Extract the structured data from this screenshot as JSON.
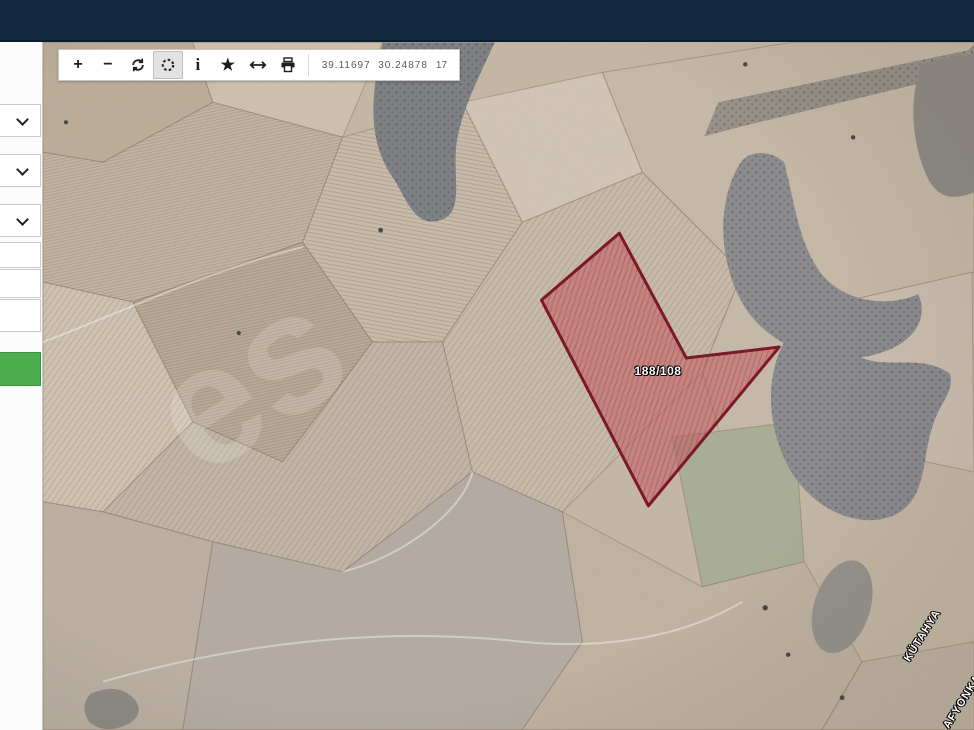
{
  "toolbar": {
    "zoom_in_glyph": "+",
    "zoom_out_glyph": "−",
    "info_glyph": "i",
    "star_glyph": "★",
    "coordinates": "39.11697  30.24878",
    "zoom_level": "17"
  },
  "sidebar": {
    "dropdown_count": 3,
    "input_count": 3,
    "submit_button_color": "#4cae4f"
  },
  "map": {
    "parcel_label": "188/108",
    "province_labels": [
      "KÜTAHYA",
      "AFYONKARAHİSAR"
    ],
    "watermark": "es"
  },
  "colors": {
    "header": "#132a40",
    "accent_green": "#4cae4f",
    "parcel_fill": "#c3555c",
    "parcel_stroke": "#7c1322",
    "terrain_base": "#c5b8a5"
  }
}
